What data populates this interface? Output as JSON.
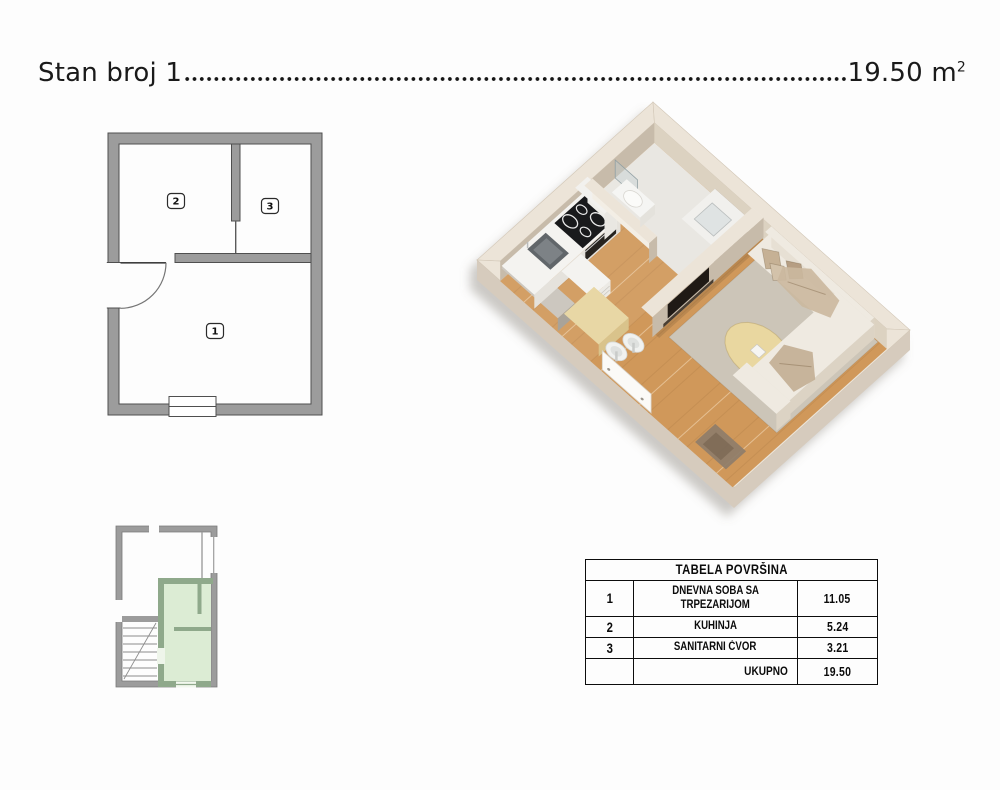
{
  "header": {
    "title": "Stan broj 1",
    "area_value": "19.50",
    "unit_base": "m",
    "unit_exp": "2"
  },
  "plan2d": {
    "room1": "1",
    "room2": "2",
    "room3": "3"
  },
  "area_table": {
    "title": "TABELA POVRŠINA",
    "rows": [
      {
        "num": "1",
        "name_lines": [
          "DNEVNA SOBA SA",
          "TRPEZARIJOM"
        ],
        "area": "11.05"
      },
      {
        "num": "2",
        "name_lines": [
          "KUHINJA",
          ""
        ],
        "area": "5.24"
      },
      {
        "num": "3",
        "name_lines": [
          "SANITARNI ĆVOR",
          ""
        ],
        "area": "3.21"
      }
    ],
    "total_label": "UKUPNO",
    "total_value": "19.50"
  },
  "colors": {
    "plan_wall": "#9c9c9c",
    "plan_outline": "#4f4f4f",
    "site_gray_wall": "#9c9c9c",
    "site_green_wall": "#8fa98b",
    "site_green_fill": "#dcecd4",
    "iso": {
      "wall_outer": "#d6cbbd",
      "wall_top": "#ece4d8",
      "face_shade": "#c7bbaa",
      "face_mid": "#dcd2c1",
      "face_light": "#f3eee5",
      "wood": "#d0985a",
      "bath_floor": "#e9e7e2",
      "rug": "#ccc5b8",
      "round_rug": "#e9d7a0",
      "sofa_top": "#efeae1",
      "sofa_front": "#dcd3c4",
      "sofa_side": "#e7e0d4",
      "pillow": "#c6b195",
      "pillow2": "#b69e83",
      "blanket": "#cbb89f",
      "counter_top": "#f4f3f0",
      "counter_front": "#e5e2dc",
      "cooktop": "#191a1c",
      "steel": "#61666a",
      "vanity_wood": "#6f5742",
      "vanity_side": "#7e644c",
      "tv": "#201a15",
      "door": "#fbfaf7",
      "mat": "#8e7d6a",
      "table_top": "#e8d7a5",
      "table_side": "#d9c38b",
      "chair": "#f1f2f0",
      "gray_cab": "#b5afa6",
      "gray_cab_top": "#ccc7bf"
    }
  }
}
